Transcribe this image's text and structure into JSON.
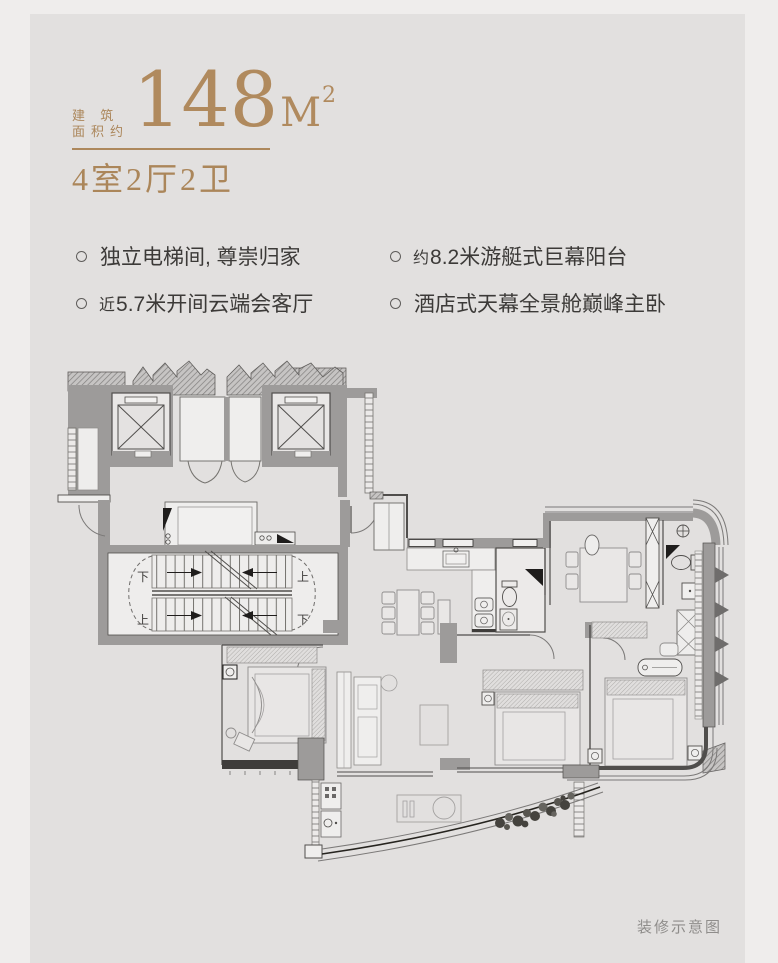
{
  "page": {
    "outer_bg": "#efedec",
    "card_bg": "#e2e0df",
    "accent_color": "#ad885c"
  },
  "header": {
    "area_prefix_line1": "建 筑",
    "area_prefix_line2": "面积约",
    "area_number": "148",
    "area_unit": "M",
    "area_exponent": "2",
    "layout_text": "4室2厅2卫"
  },
  "features": {
    "columns": [
      {
        "items": [
          {
            "prefix": "",
            "text": "独立电梯间, 尊崇归家"
          },
          {
            "prefix": "近",
            "text": "5.7米开间云端会客厅"
          }
        ]
      },
      {
        "items": [
          {
            "prefix": "约",
            "text": "8.2米游艇式巨幕阳台"
          },
          {
            "prefix": "",
            "text": "酒店式天幕全景舱巅峰主卧"
          }
        ]
      }
    ]
  },
  "floorplan": {
    "stair_labels": {
      "tl": "下",
      "tr": "上",
      "bl": "上",
      "br": "下"
    }
  },
  "caption": "装修示意图"
}
